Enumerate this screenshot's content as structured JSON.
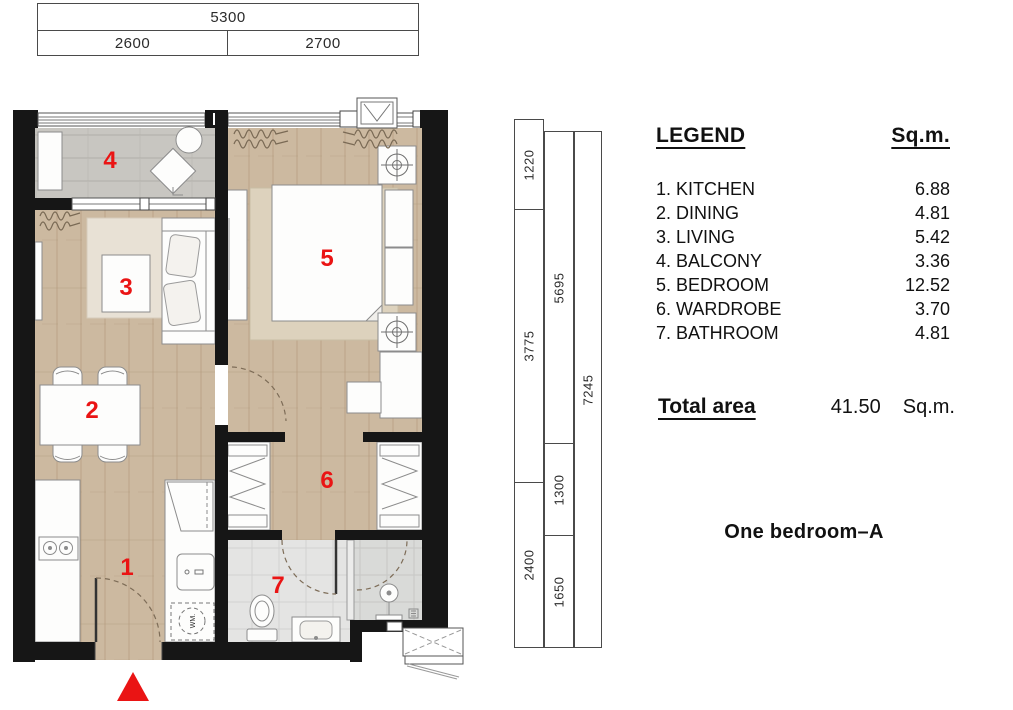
{
  "plan_name": "One bedroom–A",
  "legend": {
    "title": "LEGEND",
    "unit_header": "Sq.m.",
    "items": [
      {
        "number": "1",
        "label": "1. KITCHEN",
        "area": "6.88"
      },
      {
        "number": "2",
        "label": "2. DINING",
        "area": "4.81"
      },
      {
        "number": "3",
        "label": "3. LIVING",
        "area": "5.42"
      },
      {
        "number": "4",
        "label": "4. BALCONY",
        "area": "3.36"
      },
      {
        "number": "5",
        "label": "5. BEDROOM",
        "area": "12.52"
      },
      {
        "number": "6",
        "label": "6. WARDROBE",
        "area": "3.70"
      },
      {
        "number": "7",
        "label": "7. BATHROOM",
        "area": "4.81"
      }
    ]
  },
  "total_area": {
    "label": "Total area",
    "value": "41.50",
    "unit": "Sq.m."
  },
  "dimensions": {
    "top": {
      "overall": "5300",
      "segments": [
        "2600",
        "2700"
      ]
    },
    "right": {
      "inner": [
        "1220",
        "3775",
        "2400"
      ],
      "middle": [
        "5695",
        "1300",
        "1650"
      ],
      "outer": [
        "7245"
      ]
    }
  },
  "plan_labels": {
    "washing_machine": "WM."
  },
  "colors": {
    "accent_red": "#ea1414",
    "wall": "#161616",
    "wood_floor": "#ccb9a0",
    "balcony_floor": "#c8c6c1",
    "bathroom_floor": "#e4e4e3"
  }
}
